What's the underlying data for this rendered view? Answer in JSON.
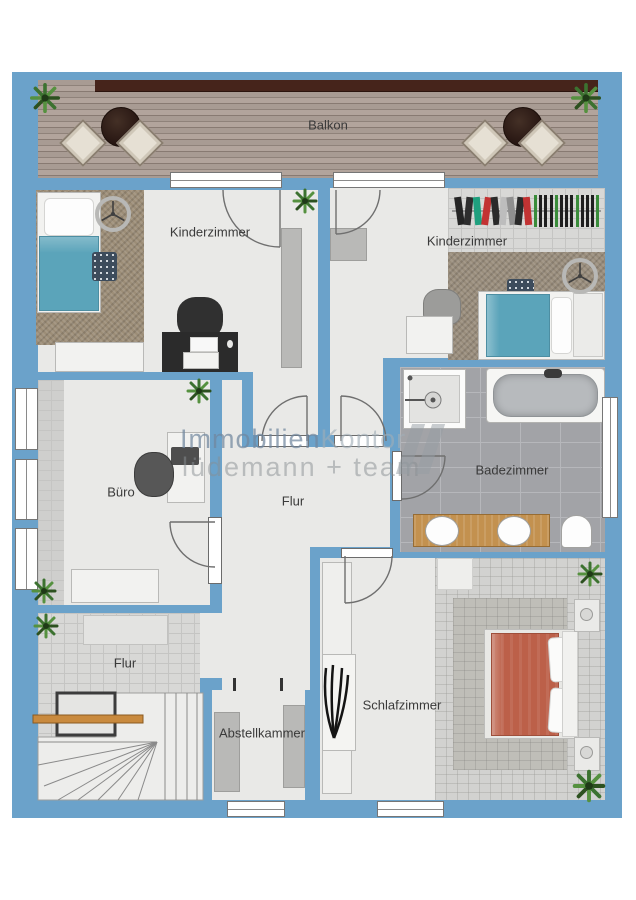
{
  "floorplan": {
    "watermark": {
      "brand_primary": "Immobilien",
      "brand_secondary": "Kontor",
      "tagline": "lüdemann + team"
    },
    "rooms": {
      "balkon": {
        "label": "Balkon"
      },
      "kinderzimmer_links": {
        "label": "Kinderzimmer"
      },
      "kinderzimmer_rechts": {
        "label": "Kinderzimmer"
      },
      "buero": {
        "label": "Büro"
      },
      "flur": {
        "label": "Flur"
      },
      "badezimmer": {
        "label": "Badezimmer"
      },
      "flur_unten": {
        "label": "Flur"
      },
      "schlafzimmer": {
        "label": "Schlafzimmer"
      },
      "abstellkammer": {
        "label": "Abstellkammer"
      }
    },
    "colors": {
      "wall": "#6ba2ca",
      "floor": "#e9e9e7",
      "tileLight": "#d8d8d6",
      "tileGrout": "#c5c5c3",
      "badTile": "#a2a3a7",
      "badGrout": "#b6b7bb",
      "carpet": "#d2d2d0",
      "rugGray": "#bfbeb8",
      "rugBrown": "#9c8d77",
      "deck": "#a3948c",
      "railing": "#46241b",
      "teal": "#5ba4ba",
      "red": "#bc6049",
      "wood": "#c3914f",
      "stairWood": "#c98a3e",
      "furnWhite": "#f2f2f0",
      "furnGray": "#b9b9b7",
      "dark": "#2b2b2b"
    }
  }
}
